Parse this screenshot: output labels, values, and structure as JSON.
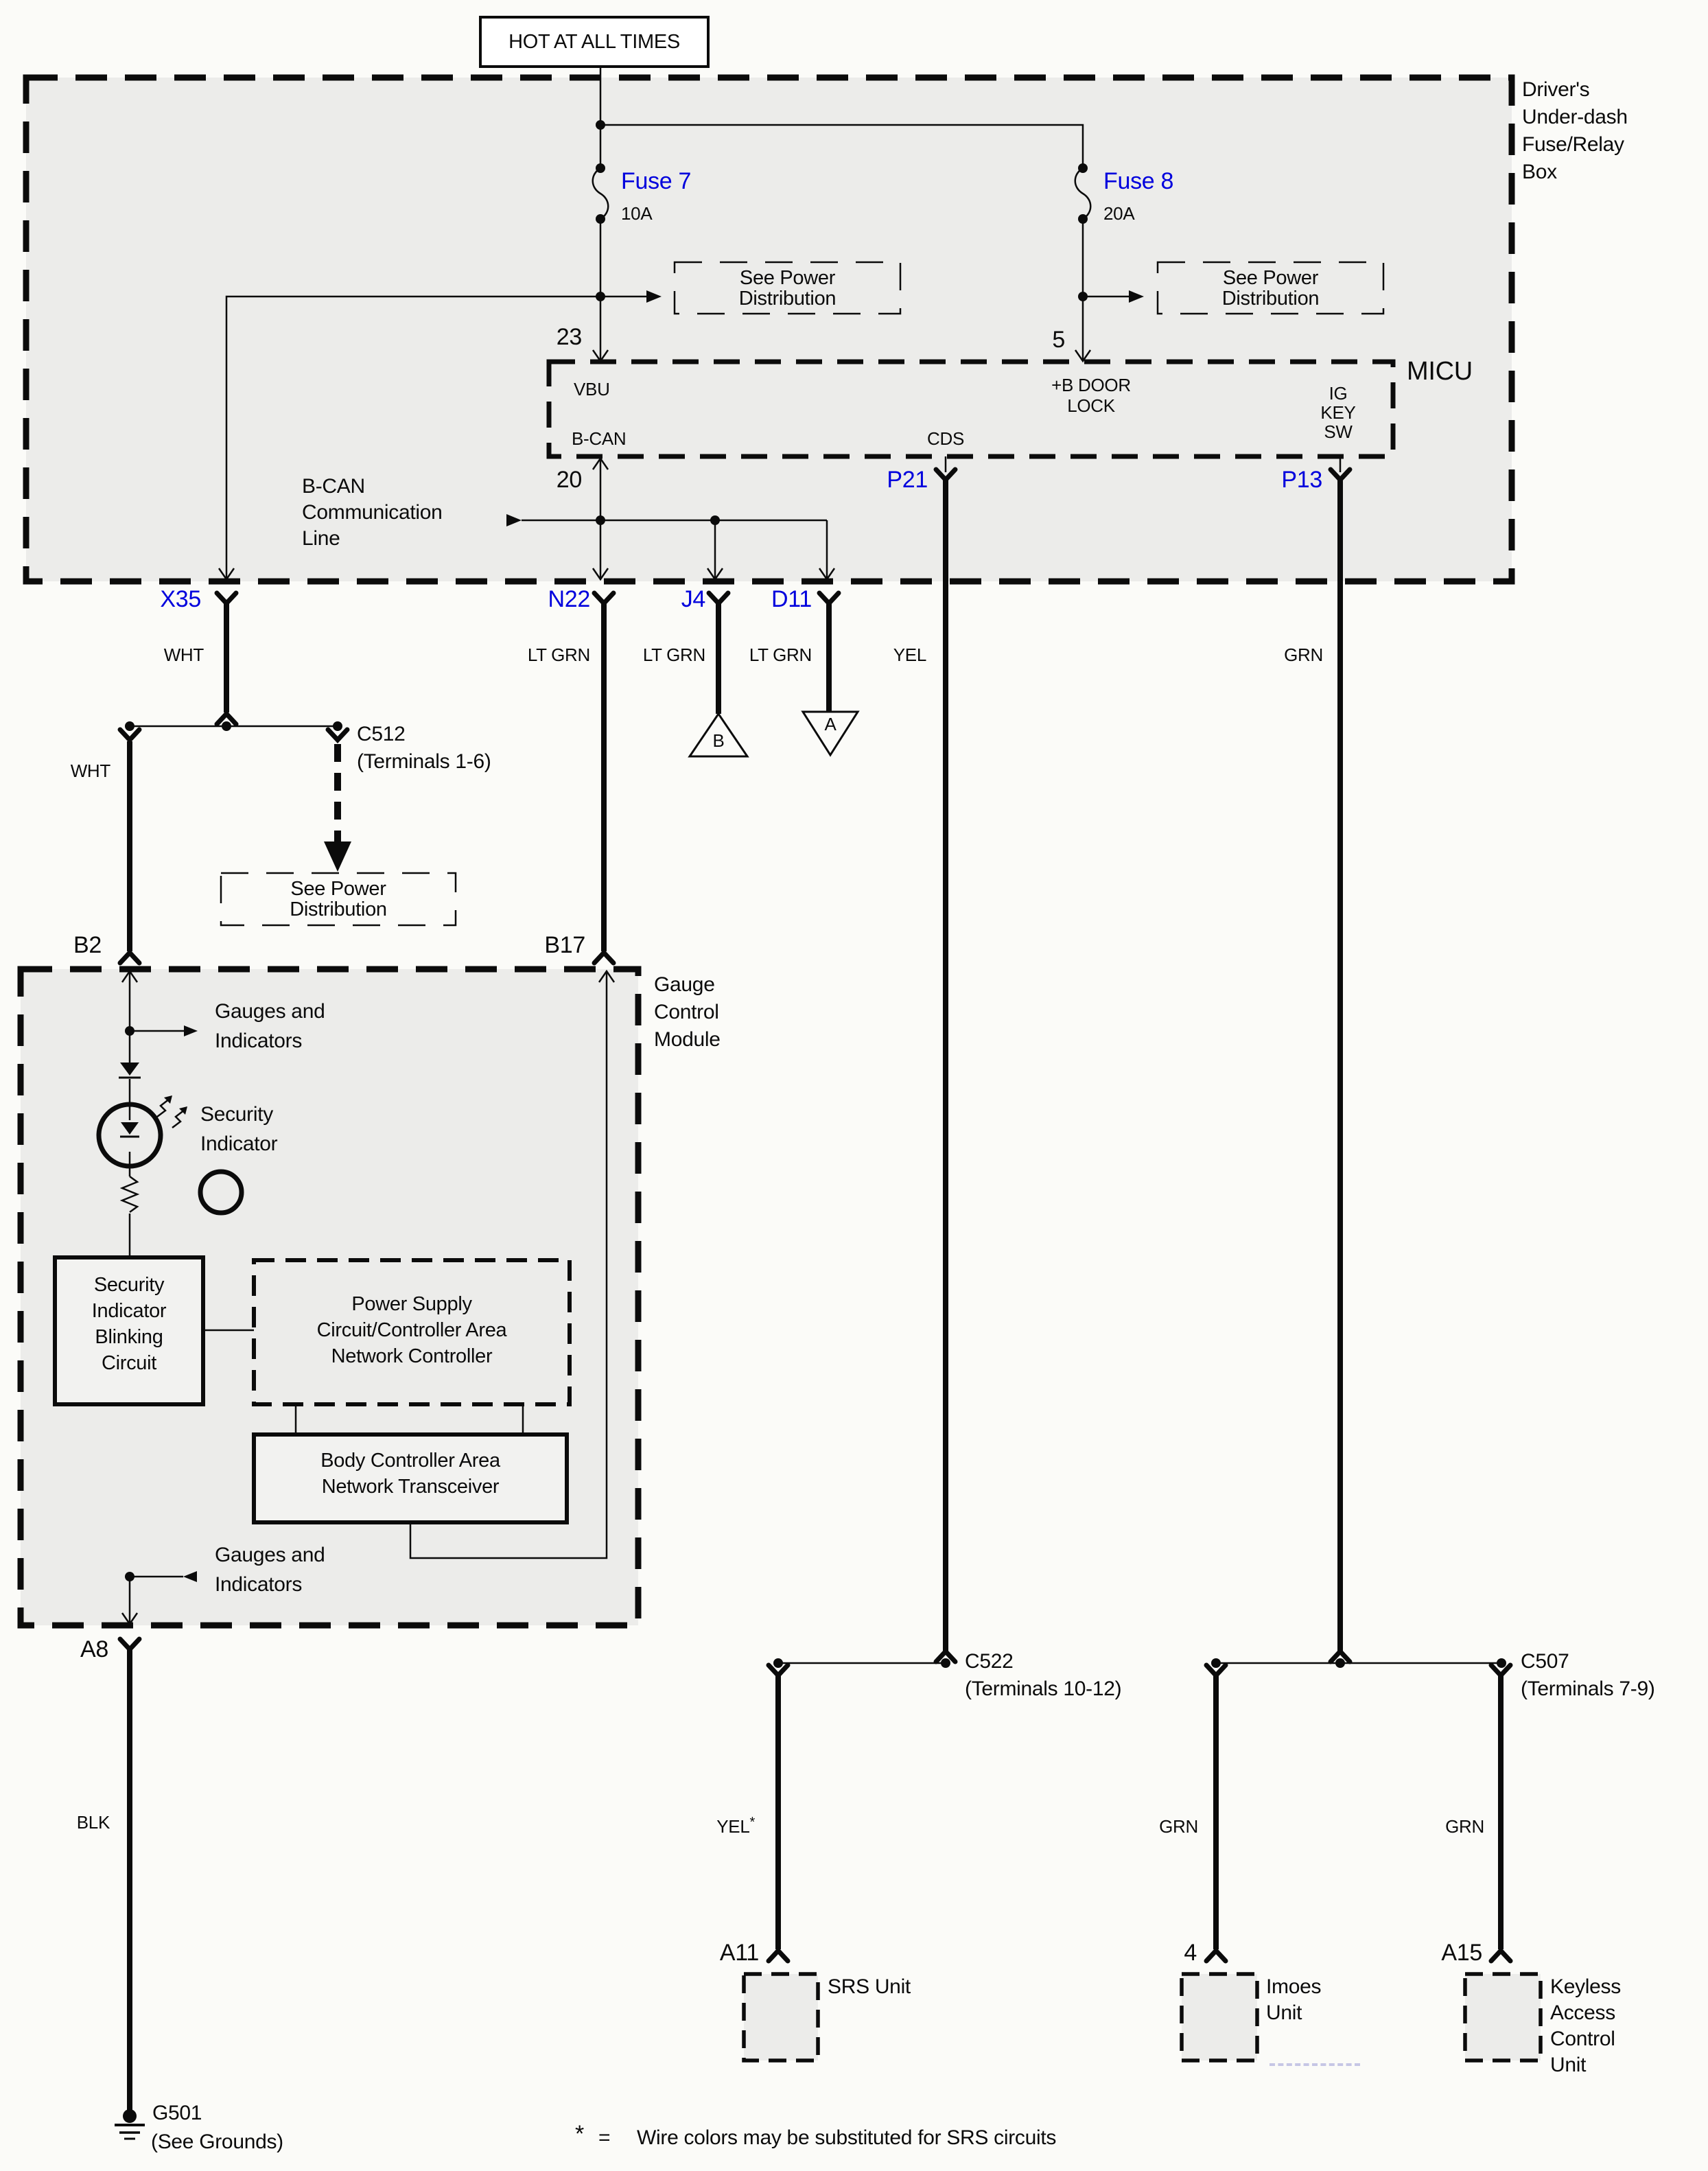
{
  "colors": {
    "blue": "#0000dd",
    "ink": "#0b0b0b",
    "panel": "#ececea",
    "bg": "#fbfbf8"
  },
  "header": {
    "hot": "HOT AT ALL TIMES"
  },
  "fuse_relay_box": {
    "label": [
      "Driver's",
      "Under-dash",
      "Fuse/Relay",
      "Box"
    ]
  },
  "fuse7": {
    "name": "Fuse 7",
    "amps": "10A",
    "pin": "23"
  },
  "fuse8": {
    "name": "Fuse 8",
    "amps": "20A",
    "pin": "5"
  },
  "power_dist": {
    "line1": "See Power",
    "line2": "Distribution"
  },
  "micu": {
    "label": "MICU",
    "vbu": "VBU",
    "b_door": [
      "+B DOOR",
      "LOCK"
    ],
    "ig_key": [
      "IG",
      "KEY",
      "SW"
    ],
    "b_can": "B-CAN",
    "cds": "CDS",
    "pin20": "20",
    "p21": "P21",
    "p13": "P13"
  },
  "b_can_line": [
    "B-CAN",
    "Communication",
    "Line"
  ],
  "conn": {
    "x35": "X35",
    "n22": "N22",
    "j4": "J4",
    "d11": "D11",
    "b2": "B2",
    "b17": "B17",
    "a8": "A8",
    "a11": "A11",
    "imoes_pin": "4",
    "a15": "A15",
    "c512": [
      "C512",
      "(Terminals 1-6)"
    ],
    "c522": [
      "C522",
      "(Terminals 10-12)"
    ],
    "c507": [
      "C507",
      "(Terminals 7-9)"
    ]
  },
  "wire": {
    "wht": "WHT",
    "lt_grn": "LT GRN",
    "yel": "YEL",
    "grn": "GRN",
    "blk": "BLK",
    "star": "*"
  },
  "inline": {
    "tri_b": "B",
    "tri_a": "A"
  },
  "module": {
    "label": [
      "Gauge",
      "Control",
      "Module"
    ],
    "gauges": [
      "Gauges and",
      "Indicators"
    ],
    "security": [
      "Security",
      "Indicator"
    ],
    "blinking": [
      "Security",
      "Indicator",
      "Blinking",
      "Circuit"
    ],
    "power_supply": [
      "Power Supply",
      "Circuit/Controller Area",
      "Network Controller"
    ],
    "transceiver": [
      "Body Controller Area",
      "Network Transceiver"
    ]
  },
  "ground": {
    "name": "G501",
    "note": "(See Grounds)"
  },
  "units": {
    "srs": "SRS Unit",
    "imoes": [
      "Imoes",
      "Unit"
    ],
    "keyless": [
      "Keyless",
      "Access",
      "Control",
      "Unit"
    ]
  },
  "footnote": {
    "star": "*",
    "eq": "=",
    "text": "Wire colors may be substituted for SRS circuits"
  }
}
